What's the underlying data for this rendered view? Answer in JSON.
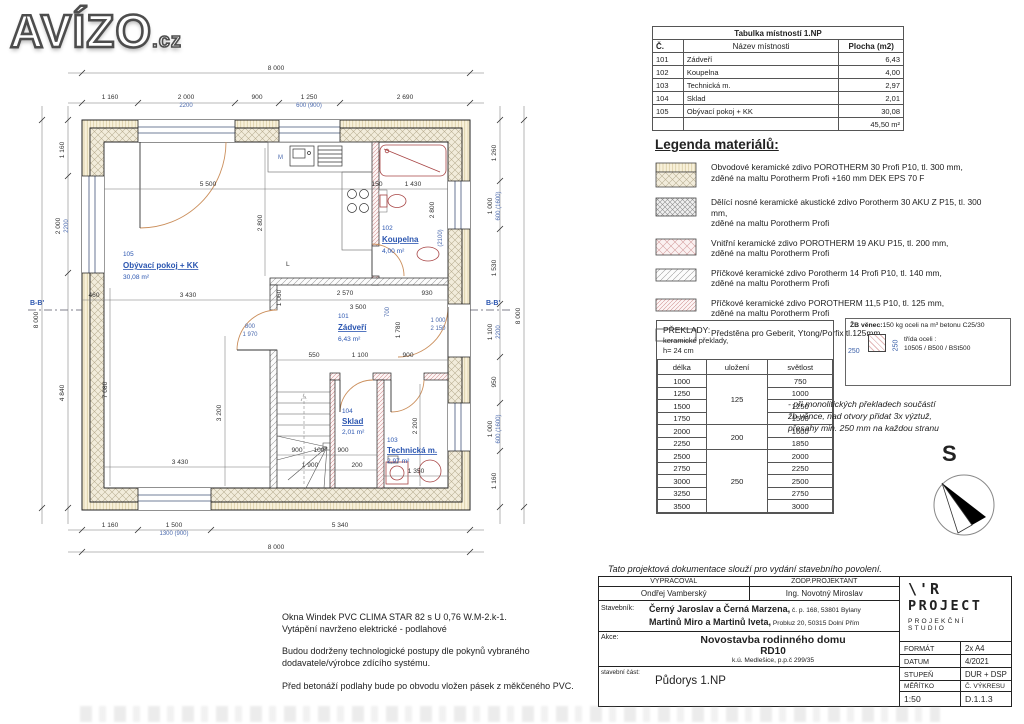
{
  "logo": {
    "main": "AVÍZO",
    "suffix": ".cz"
  },
  "room_table": {
    "title": "Tabulka místností 1.NP",
    "headers": {
      "c": "Č.",
      "n": "Název místnosti",
      "p": "Plocha (m2)"
    },
    "rows": [
      {
        "c": "101",
        "n": "Zádveří",
        "p": "6,43"
      },
      {
        "c": "102",
        "n": "Koupelna",
        "p": "4,00"
      },
      {
        "c": "103",
        "n": "Technická m.",
        "p": "2,97"
      },
      {
        "c": "104",
        "n": "Sklad",
        "p": "2,01"
      },
      {
        "c": "105",
        "n": "Obývací pokoj + KK",
        "p": "30,08"
      }
    ],
    "total": "45,50 m²"
  },
  "legend": {
    "title": "Legenda materiálů:",
    "items": [
      {
        "l1": "Obvodové keramické zdivo POROTHERM 30 Profi P10, tl. 300 mm,",
        "l2": "zděné na maltu Porotherm Profi +160 mm DEK EPS 70 F"
      },
      {
        "l1": "Dělící nosné keramické akustické zdivo Porotherm 30 AKU Z P15, tl. 300 mm,",
        "l2": "zděné na maltu Porotherm Profi"
      },
      {
        "l1": "Vnitřní keramické zdivo POROTHERM 19 AKU P15, tl. 200 mm,",
        "l2": "zděné na maltu Porotherm Profi"
      },
      {
        "l1": "Příčkové keramické zdivo Porotherm 14 Profi P10, tl. 140 mm,",
        "l2": "zděné na maltu Porotherm Profi"
      },
      {
        "l1": "Příčkové keramické zdivo POROTHERM 11,5 P10, tl. 125 mm,",
        "l2": "zděné na maltu Porotherm Profi"
      },
      {
        "l1": "Předstěna pro Geberit, Ytong/Porfix tl.125mm",
        "l2": ""
      }
    ]
  },
  "preklady": {
    "title": "PŘEKLADY:",
    "sub1": "keramické překlady,",
    "sub2": "h= 24 cm",
    "headers": [
      "délka",
      "uložení",
      "světlost"
    ],
    "delka": [
      "1000",
      "1250",
      "1500",
      "1750",
      "2000",
      "2250",
      "2500",
      "2750",
      "3000",
      "3250",
      "3500"
    ],
    "svetlost": [
      "750",
      "1000",
      "1250",
      "1500",
      "1600",
      "1850",
      "2000",
      "2250",
      "2500",
      "2750",
      "3000"
    ],
    "uloz": [
      "125",
      "200",
      "250"
    ]
  },
  "zb": {
    "title": "ŽB věnec:",
    "t1": "150 kg oceli na m³ betonu C25/30",
    "t2": "třída oceli :",
    "t3": "10505 / B500 / BSt500",
    "dim": "250"
  },
  "mono_note": {
    "l1": "- při monolitických překladech součástí",
    "l2": "žb věnce, nad otvory přidat 3x výztuž,",
    "l3": "přesahy min. 250 mm na každou stranu"
  },
  "compass": {
    "label": "S"
  },
  "notes": {
    "n1a": "Okna Windek PVC CLIMA STAR 82 s U 0,76 W.M-2.k-1.",
    "n1b": "Vytápění navrženo elektrické - podlahové",
    "n2a": "Budou dodrženy technologické postupy dle pokynů vybraného",
    "n2b": "dodavatele/výrobce zdícího systému.",
    "n3": "Před betonáží podlahy bude po obvodu vložen pásek z měkčeného PVC."
  },
  "titleblock": {
    "note": "Tato projektová dokumentace slouží pro vydání stavebního povolení.",
    "vypracoval_label": "VYPRACOVAL",
    "zodp_label": "ZODP.PROJEKTANT",
    "vypracoval": "Ondřej Vamberský",
    "zodp": "Ing. Novotný Miroslav",
    "stavebnik_label": "Stavebník:",
    "s1b": "Černý Jaroslav a Černá Marzena,",
    "s1s": " č. p. 168, 53801 Bylany",
    "s2b": "Martinů Miro a Martinů Iveta,",
    "s2s": " Probluz 20, 50315 Dolní Přím",
    "akce_label": "Akce:",
    "a1": "Novostavba rodinného domu",
    "a2": "RD10",
    "a3": "k.ú. Medlešice, p.p.č 299/35",
    "cast_label": "stavební část:",
    "cast": "Půdorys 1.NP",
    "logo1": "\\'R",
    "logo2": "PROJECT",
    "logo3": "PROJEKČNÍ",
    "logo4": "STUDIO",
    "format_label": "FORMÁT",
    "format": "2x A4",
    "datum_label": "DATUM",
    "datum": "4/2021",
    "stupen_label": "STUPEŇ",
    "stupen": "DUR + DSP",
    "meritko_label": "MĚŘÍTKO",
    "vykres_label": "Č. VÝKRESU",
    "meritko": "1:50",
    "vykres": "D.1.1.3"
  },
  "plan": {
    "dims": {
      "d8000": "8 000",
      "d1160": "1 160",
      "d2000": "2 000",
      "d2200": "2200",
      "d900": "900",
      "d1250": "1 250",
      "d600_900": "600 (900)",
      "d2690": "2 690",
      "d4840": "4 840",
      "d1260": "1 260",
      "d1000": "1 000",
      "d600_1600": "600 (1600)",
      "d1530": "1 530",
      "d1100": "1 100",
      "d950": "950",
      "d1500": "1 500",
      "d1300_900": "1300 (900)",
      "d5340": "5 340",
      "d5500": "5 500",
      "d150": "150",
      "d1430": "1 430",
      "d2800": "2 800",
      "d2100": "(2100)",
      "d460": "460",
      "d3430": "3 430",
      "d1060": "1 060",
      "d2570": "2 570",
      "d3500": "3 500",
      "d930": "930",
      "d7080": "7 080",
      "d3200": "3 200",
      "d800": "800",
      "d1970": "1 970",
      "d550": "550",
      "d1780": "1 780",
      "d2150": "2 150",
      "d700": "700",
      "d100": "100",
      "d1900": "1 900",
      "d200": "200",
      "d2200s": "2 200",
      "d1350": "1 350",
      "bb": "B-B'"
    },
    "rooms": {
      "living": {
        "num": "105",
        "name": "Obývací pokoj + KK",
        "area": "30,08 m²"
      },
      "hall": {
        "num": "101",
        "name": "Zádveří",
        "area": "6,43 m²"
      },
      "bath": {
        "num": "102",
        "name": "Koupelna",
        "area": "4,00 m²"
      },
      "storage": {
        "num": "104",
        "name": "Sklad",
        "area": "2,01 m²"
      },
      "tech": {
        "num": "103",
        "name": "Technická m.",
        "area": "2,97 m²"
      }
    },
    "marks": {
      "m": "M",
      "l": "L"
    }
  }
}
